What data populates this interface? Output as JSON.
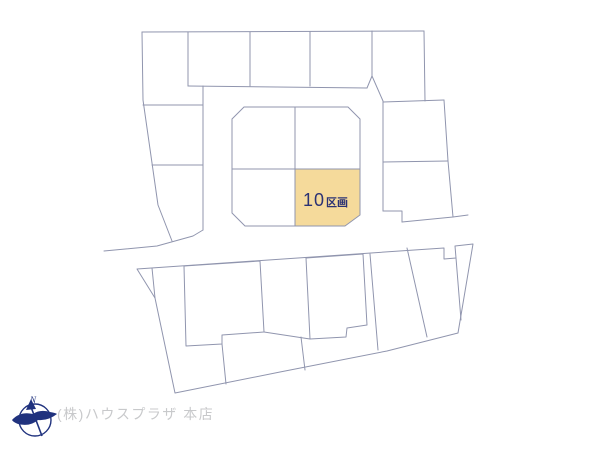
{
  "map": {
    "highlighted_lot": {
      "number": "10",
      "unit_label": "区画",
      "fill_color": "#f5da9b",
      "label_color": "#2b3274"
    },
    "line_color": "#9095ae"
  },
  "footer": {
    "compass_north_label": "N",
    "compass_color": "#20327e",
    "company_name": "(株)ハウスプラザ 本店",
    "company_color": "#c8c9cb"
  }
}
